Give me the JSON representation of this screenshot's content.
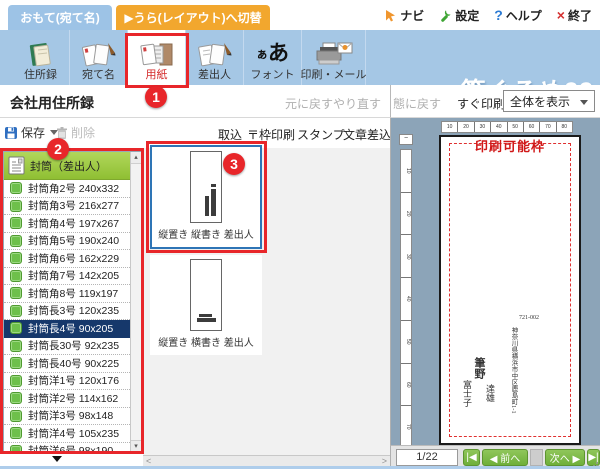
{
  "colors": {
    "toolbar_blue": "#a5c7e5",
    "tab_blue": "#9dc3e6",
    "tab_orange": "#f2a72e",
    "annotation_red": "#e8262a",
    "selection_blue": "#2e75b6",
    "selected_row_navy": "#16386b",
    "list_header_green": "#9cc83f",
    "item_icon_green": "#6ec04b",
    "nav_button_green": "#7cb944",
    "preview_bg": "#8ca4b8",
    "printable_red": "#d01818"
  },
  "topbar": {
    "front_tab": "おもて(宛て名)",
    "back_tab": "▶うら(レイアウト)へ切替",
    "nav": "ナビ",
    "settings": "設定",
    "help_mark": "?",
    "help": "ヘルプ",
    "exit_mark": "×",
    "exit": "終了"
  },
  "toolbar": {
    "items": [
      {
        "label": "住所録"
      },
      {
        "label": "宛て名"
      },
      {
        "label": "用紙"
      },
      {
        "label": "差出人"
      },
      {
        "label": "フォント"
      },
      {
        "label": "印刷・メール"
      }
    ],
    "active_item": "用紙",
    "font_icon_small": "ぁ",
    "font_icon_large": "あ",
    "logo": "筆ぐるめ23"
  },
  "title_row": {
    "title": "会社用住所録",
    "undo": "元に戻す",
    "redo": "やり直す"
  },
  "left_panel": {
    "save": "保存",
    "delete": "削除",
    "list_header": "封筒（差出人）",
    "items": [
      "封筒角2号 240x332",
      "封筒角3号 216x277",
      "封筒角4号 197x267",
      "封筒角5号 190x240",
      "封筒角6号 162x229",
      "封筒角7号 142x205",
      "封筒角8号 119x197",
      "封筒長3号 120x235",
      "封筒長4号 90x205",
      "封筒長30号 92x235",
      "封筒長40号 90x225",
      "封筒洋1号 120x176",
      "封筒洋2号 114x162",
      "封筒洋3号 98x148",
      "封筒洋4号 105x235",
      "封筒洋6号 98x190"
    ],
    "selected_item": "封筒長4号 90x205",
    "selected_index": 8
  },
  "middle_panel": {
    "actions": [
      "取込",
      "〒枠印刷",
      "スタンプ",
      "文章差込"
    ],
    "previews": [
      {
        "label": "縦置き 縦書き 差出人",
        "selected": true
      },
      {
        "label": "縦置き 横書き 差出人",
        "selected": false
      }
    ]
  },
  "right_panel": {
    "restore_truncated": "態に戻す",
    "quick_print": "すぐ印刷",
    "view_mode": "全体を表示",
    "printable_frame": "印刷可能枠",
    "corner_mark": "−",
    "ruler_h": [
      "10",
      "20",
      "30",
      "40",
      "50",
      "60",
      "70",
      "80"
    ],
    "ruler_v": [
      "10",
      "20",
      "30",
      "40",
      "50",
      "60",
      "70"
    ],
    "sender": {
      "postal_code": "721-002",
      "address": "神奈川県横浜市中区鹿島町1-1",
      "family_name": "筆野",
      "given_name_1": "達雄",
      "given_name_2": "富士子"
    },
    "pager": {
      "page": "1/22",
      "first": "|◀",
      "prev": "◀ 前へ",
      "next": "次へ ▶",
      "last": "▶|"
    }
  },
  "annotations": {
    "step1": "1",
    "step2": "2",
    "step3": "3"
  },
  "scrollbar": {
    "up": "▴",
    "down": "▾",
    "left": "<",
    "right": ">"
  }
}
